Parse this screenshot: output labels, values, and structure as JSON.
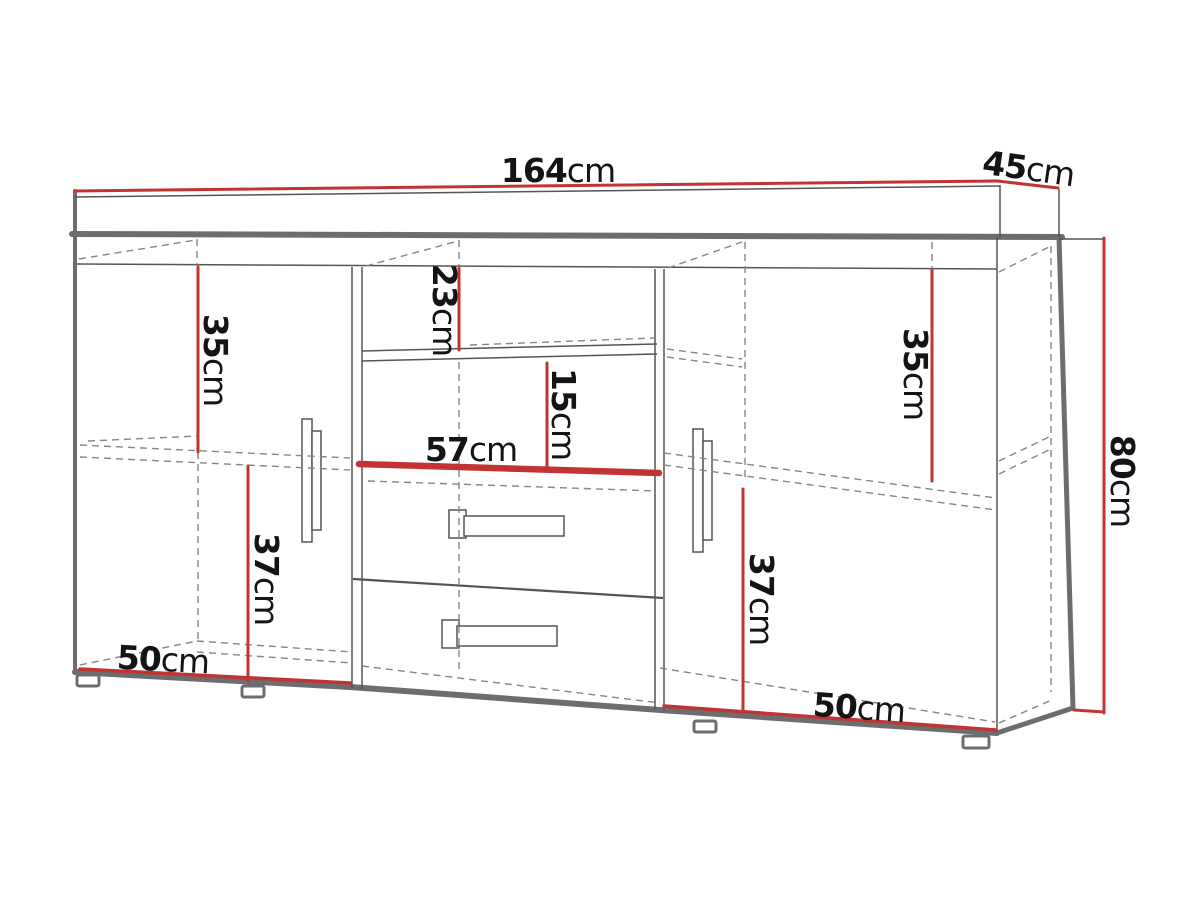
{
  "diagram": {
    "subject": "sideboard-cabinet-dimension-drawing",
    "unit_system": "cm",
    "dimensions": {
      "width": {
        "value": "164",
        "unit": "cm"
      },
      "depth": {
        "value": "45",
        "unit": "cm"
      },
      "height": {
        "value": "80",
        "unit": "cm"
      },
      "left_top": {
        "value": "35",
        "unit": "cm"
      },
      "left_bottom": {
        "value": "37",
        "unit": "cm"
      },
      "left_width": {
        "value": "50",
        "unit": "cm"
      },
      "middle_top": {
        "value": "23",
        "unit": "cm"
      },
      "middle_middle": {
        "value": "15",
        "unit": "cm"
      },
      "middle_width": {
        "value": "57",
        "unit": "cm"
      },
      "right_top": {
        "value": "35",
        "unit": "cm"
      },
      "right_bottom": {
        "value": "37",
        "unit": "cm"
      },
      "right_width": {
        "value": "50",
        "unit": "cm"
      }
    },
    "colors": {
      "dimension_line": "#c23434",
      "outline": "#6d6d6d",
      "thin_line": "#555555",
      "dashed_line": "#868686",
      "text": "#141414",
      "background": "#ffffff"
    }
  }
}
